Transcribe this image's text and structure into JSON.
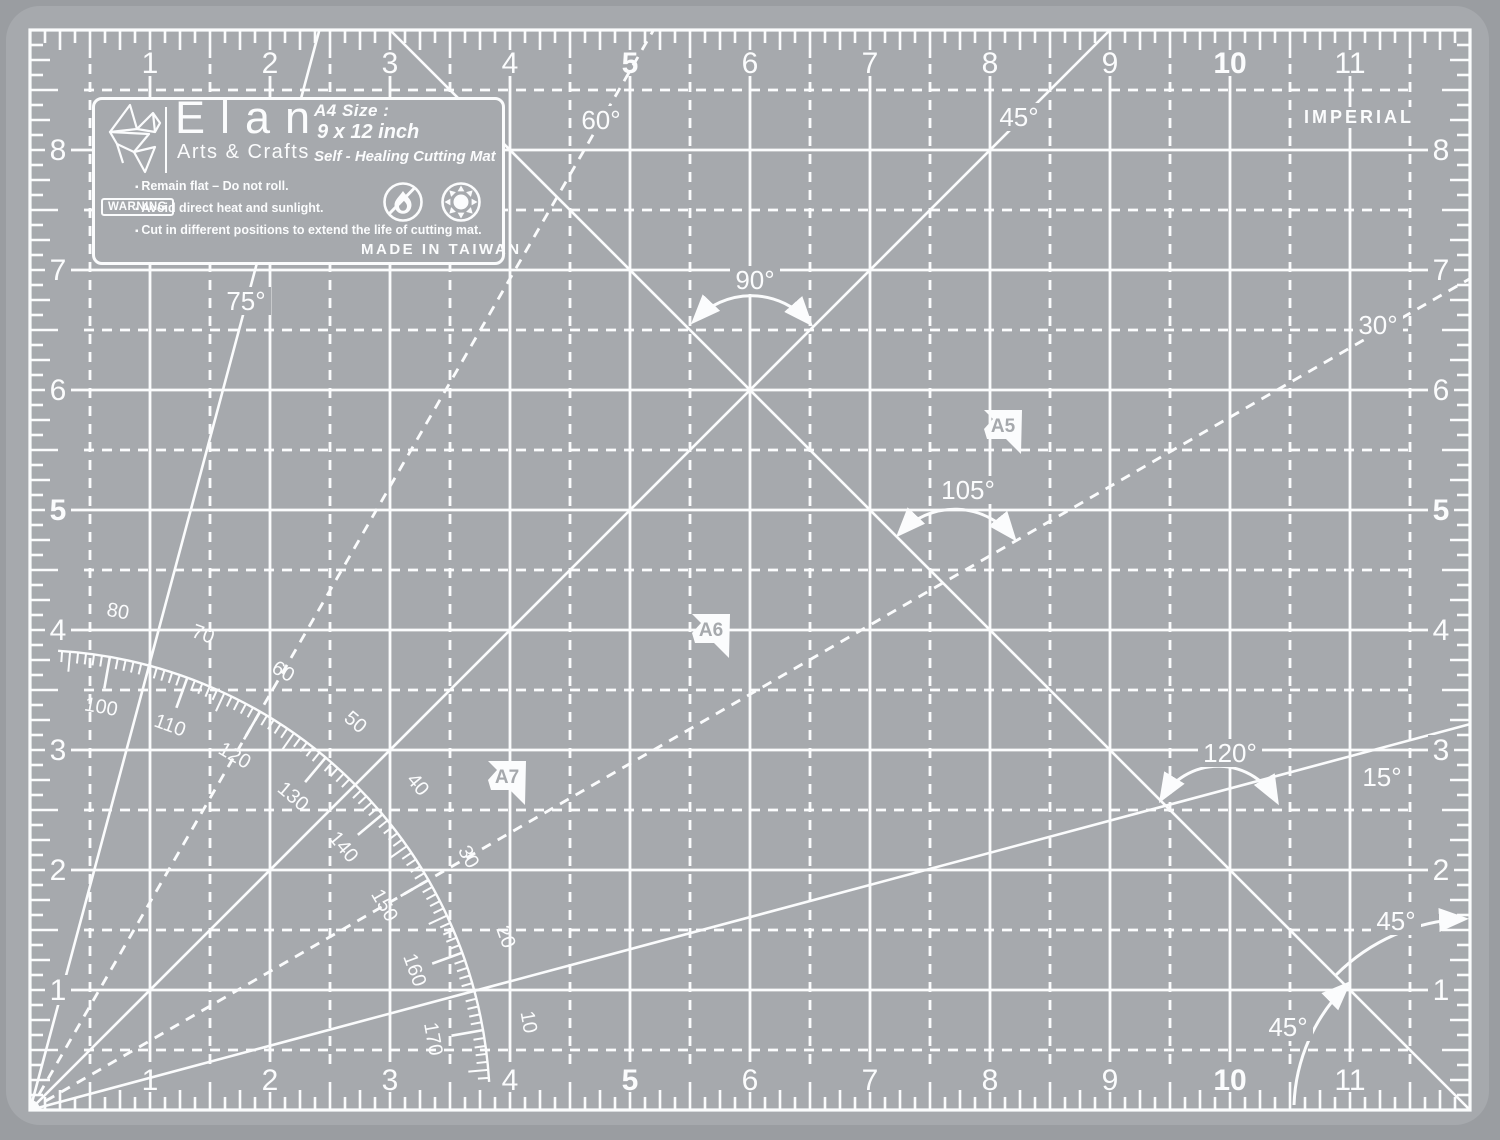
{
  "colors": {
    "background": "#9a9da1",
    "mat": "#a6a9ad",
    "ink": "#fbfcfd"
  },
  "imperial": "IMPERIAL",
  "plate": {
    "brand": "Elan",
    "subtitle": "Arts & Crafts",
    "size_title": "A4 Size :",
    "size_dimensions": "9 x 12 inch",
    "product_type": "Self - Healing Cutting Mat",
    "warning_label": "WARNING",
    "bullets": [
      "Remain flat – Do not roll.",
      "Avoid direct heat and sunlight.",
      "Cut in different positions to extend the life of cutting mat."
    ],
    "made_in": "MADE IN TAIWAN",
    "icons": [
      "no-open-flame-icon",
      "no-sunlight-icon"
    ]
  },
  "rulers": {
    "top": [
      "1",
      "2",
      "3",
      "4",
      "5",
      "6",
      "7",
      "8",
      "9",
      "10",
      "11"
    ],
    "bottom": [
      "1",
      "2",
      "3",
      "4",
      "5",
      "6",
      "7",
      "8",
      "9",
      "10",
      "11"
    ],
    "left": [
      "8",
      "7",
      "6",
      "5",
      "4",
      "3",
      "2",
      "1"
    ],
    "right": [
      "8",
      "7",
      "6",
      "5",
      "4",
      "3",
      "2",
      "1"
    ],
    "bold_values": [
      "5",
      "10"
    ]
  },
  "protractor": {
    "outer_labels": [
      "10",
      "20",
      "30",
      "40",
      "50",
      "60",
      "70",
      "80"
    ],
    "inner_labels": [
      "100",
      "110",
      "120",
      "130",
      "140",
      "150",
      "160",
      "170"
    ],
    "solid_line_angles": [
      15,
      45,
      75
    ],
    "dashed_line_angles": [
      30,
      60
    ]
  },
  "angle_labels": [
    {
      "text": "75°",
      "x": 246,
      "y": 301
    },
    {
      "text": "60°",
      "x": 601,
      "y": 120
    },
    {
      "text": "45°",
      "x": 1019,
      "y": 117
    },
    {
      "text": "90°",
      "x": 755,
      "y": 280
    },
    {
      "text": "30°",
      "x": 1378,
      "y": 325
    },
    {
      "text": "105°",
      "x": 968,
      "y": 490
    },
    {
      "text": "120°",
      "x": 1230,
      "y": 753
    },
    {
      "text": "15°",
      "x": 1382,
      "y": 777
    },
    {
      "text": "45°",
      "x": 1288,
      "y": 1027
    },
    {
      "text": "45°",
      "x": 1396,
      "y": 921
    }
  ],
  "paper_flags": [
    {
      "label": "A5",
      "x": 1022,
      "y": 410
    },
    {
      "label": "A6",
      "x": 730,
      "y": 614
    },
    {
      "label": "A7",
      "x": 526,
      "y": 761
    }
  ]
}
